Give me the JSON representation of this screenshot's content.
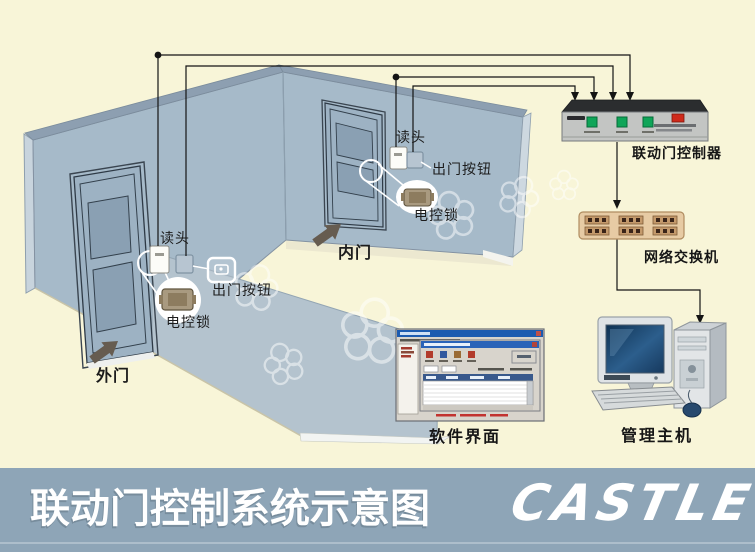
{
  "banner": {
    "title": "联动门控制系统示意图",
    "logo_text": "CASTLE",
    "registered_mark": "®"
  },
  "labels": {
    "outer_door": "外门",
    "inner_door": "内门",
    "outer_reader": "读头",
    "outer_exit_button": "出门按钮",
    "outer_lock": "电控锁",
    "inner_reader": "读头",
    "inner_exit_button": "出门按钮",
    "inner_lock": "电控锁",
    "controller": "联动门控制器",
    "network_switch": "网络交换机",
    "software_ui": "软件界面",
    "management_host": "管理主机"
  },
  "colors": {
    "background": "#f8f5d8",
    "banner": "#8ea5b7",
    "wall": "#a6bac9",
    "front_wall": "#b2c1cd",
    "controller_button_green": "#0fa558",
    "controller_switch_red": "#cf2a1b",
    "switch_body_tan": "#e7cba4",
    "title_text": "#ffffff"
  }
}
